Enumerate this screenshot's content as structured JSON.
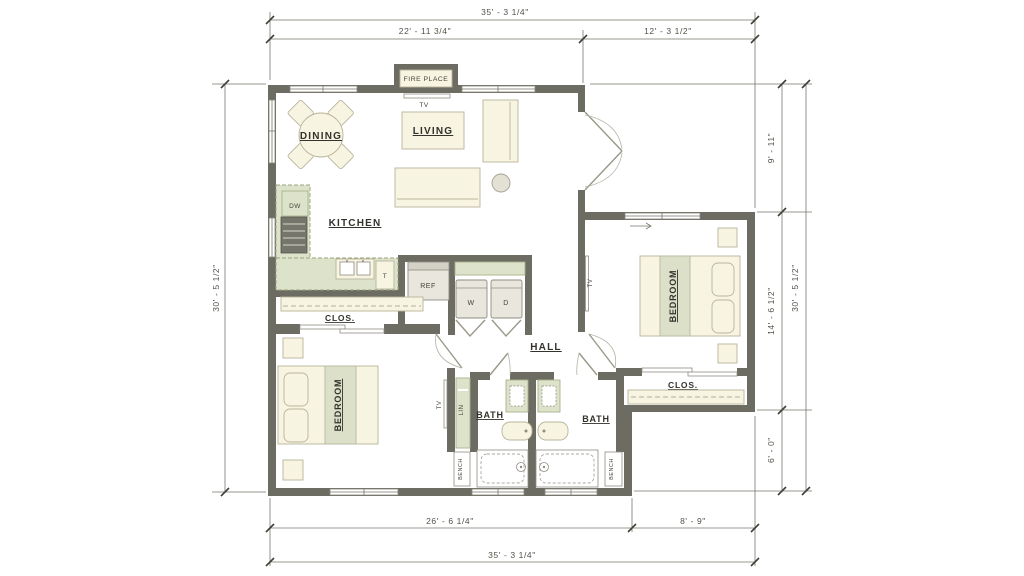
{
  "rooms": {
    "dining": "DINING",
    "living": "LIVING",
    "kitchen": "KITCHEN",
    "hall": "HALL",
    "bath_left": "BATH",
    "bath_right": "BATH",
    "bedroom_left": "BEDROOM",
    "bedroom_right": "BEDROOM",
    "closet_left": "CLOS.",
    "closet_right": "CLOS."
  },
  "fixtures": {
    "fireplace": "FIRE PLACE",
    "tv_living": "TV",
    "tv_bedroom_left": "TV",
    "tv_bedroom_right": "TV",
    "dishwasher": "DW",
    "trash": "T",
    "refrigerator": "REF",
    "washer": "W",
    "dryer": "D",
    "linen": "LIN",
    "bench_left": "BENCH",
    "bench_right": "BENCH"
  },
  "dimensions": {
    "top_overall": "35' - 3 1/4\"",
    "top_left": "22' - 11 3/4\"",
    "top_right": "12' - 3 1/2\"",
    "left_overall": "30' - 5 1/2\"",
    "right_top": "9' - 11\"",
    "right_middle": "14' - 6 1/2\"",
    "right_bottom": "6' - 0\"",
    "right_overall": "30' - 5 1/2\"",
    "bottom_left": "26' - 6 1/4\"",
    "bottom_right": "8' - 9\"",
    "bottom_overall": "35' - 3 1/4\""
  },
  "colors": {
    "wall": "#6d6c62",
    "furniture_cream": "#f7f4e1",
    "counter_green": "#dde3ca",
    "appliance_gray": "#e9e7dd",
    "dimension": "#52514a"
  }
}
